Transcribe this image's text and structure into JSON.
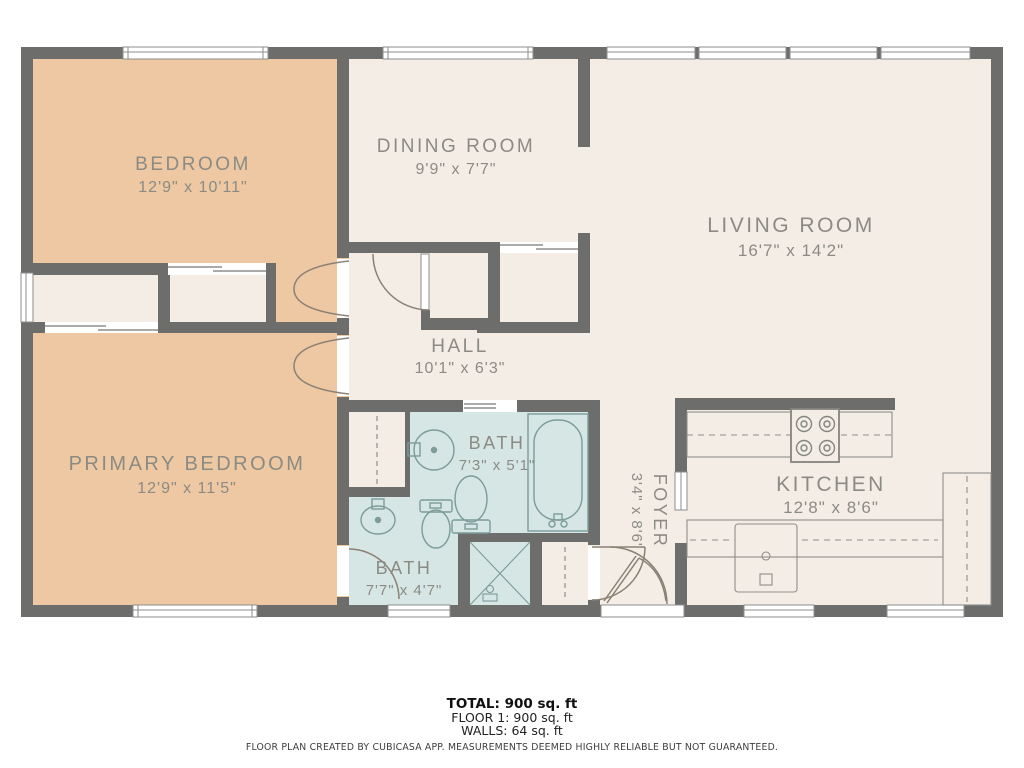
{
  "title": "Floor plan",
  "rooms": [
    {
      "id": "bedroom",
      "name": "BEDROOM",
      "dims": "12'9\" x 10'11\""
    },
    {
      "id": "dining-room",
      "name": "DINING ROOM",
      "dims": "9'9\" x 7'7\""
    },
    {
      "id": "living-room",
      "name": "LIVING ROOM",
      "dims": "16'7\" x 14'2\""
    },
    {
      "id": "hall",
      "name": "HALL",
      "dims": "10'1\" x 6'3\""
    },
    {
      "id": "primary-bedroom",
      "name": "PRIMARY BEDROOM",
      "dims": "12'9\" x 11'5\""
    },
    {
      "id": "bath-upper",
      "name": "BATH",
      "dims": "7'3\" x 5'1\""
    },
    {
      "id": "bath-lower",
      "name": "BATH",
      "dims": "7'7\" x 4'7\""
    },
    {
      "id": "foyer",
      "name": "FOYER",
      "dims": "3'4\" x 8'6\""
    },
    {
      "id": "kitchen",
      "name": "KITCHEN",
      "dims": "12'8\" x 8'6\""
    }
  ],
  "summary": {
    "total": "TOTAL: 900 sq. ft",
    "floor1": "FLOOR 1: 900 sq. ft",
    "walls": "WALLS: 64 sq. ft"
  },
  "disclaimer": "FLOOR PLAN CREATED BY CUBICASA APP. MEASUREMENTS DEEMED HIGHLY RELIABLE BUT NOT GUARANTEED.",
  "colors": {
    "wall": "#6d6d6c",
    "floor": "#f4ede6",
    "bedroom_floor": "#edc8a2",
    "bath_floor": "#d6e6e4",
    "window_line": "#8e8e8c",
    "door_arc": "#8b8074",
    "fixture_line": "#7c9b99",
    "label_text": "#8b8b84"
  }
}
